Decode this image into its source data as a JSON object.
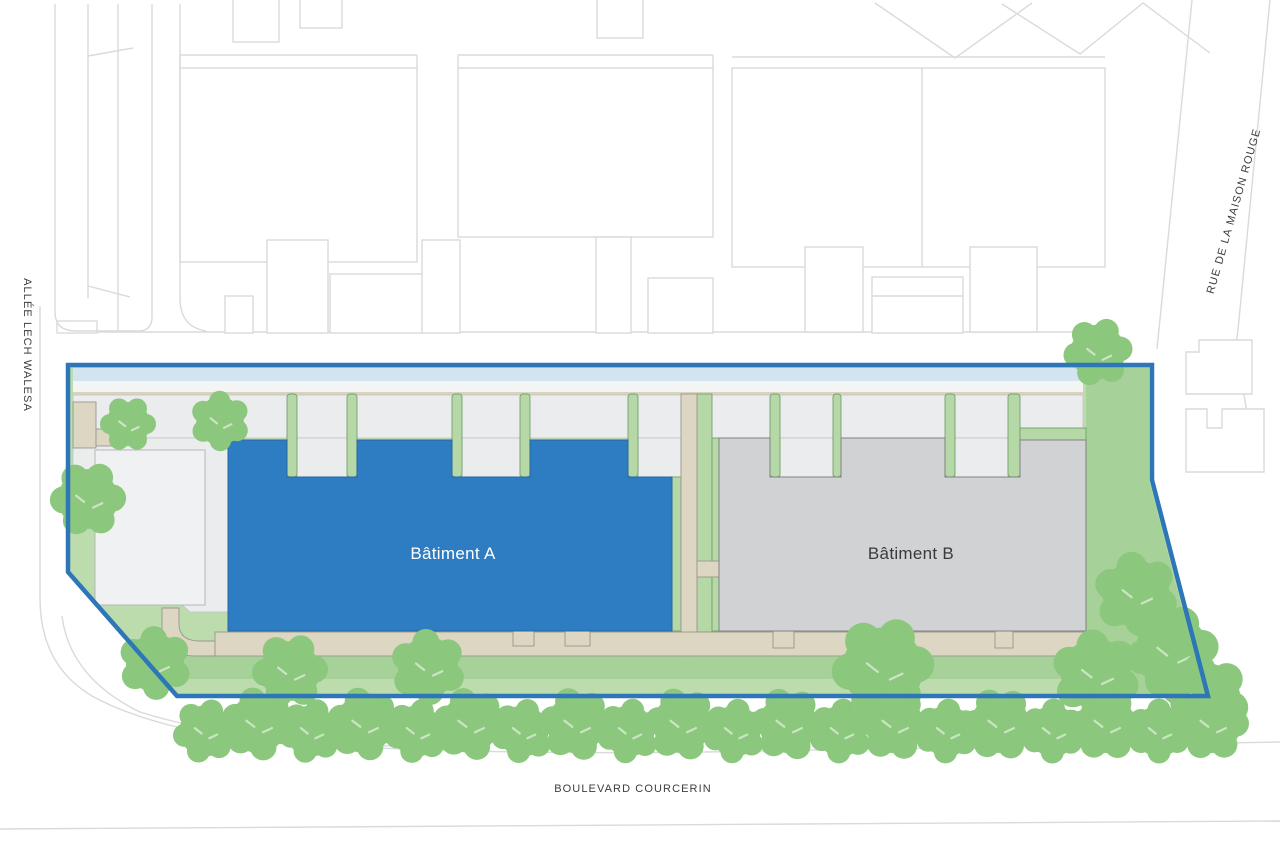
{
  "title": "Site plan — Bâtiments A et B",
  "streets": {
    "left": "ALLÉE LECH WALESA",
    "right": "RUE DE LA MAISON ROUGE",
    "bottom": "BOULEVARD COURCERIN"
  },
  "buildings": {
    "a": {
      "label": "Bâtiment A"
    },
    "b": {
      "label": "Bâtiment B"
    }
  },
  "colors": {
    "boundary_blue": "#2d76b7",
    "building_a_fill": "#2e7cc1",
    "building_a_text": "#ffffff",
    "building_b_fill": "#d0d2d4",
    "building_b_text": "#3a3a3a",
    "lawn_light": "#bcdcae",
    "lawn_medium": "#a6d299",
    "strip_green": "#b5d8a6",
    "tree_green": "#8bc77d",
    "path_beige": "#ddd6c2",
    "courtyard_gray": "#ebeced",
    "pale_band": "#f3f4f4",
    "blue_strip": "#d3e4f1",
    "context_line": "#d9dadb",
    "street_label": "#3d3d3d"
  }
}
